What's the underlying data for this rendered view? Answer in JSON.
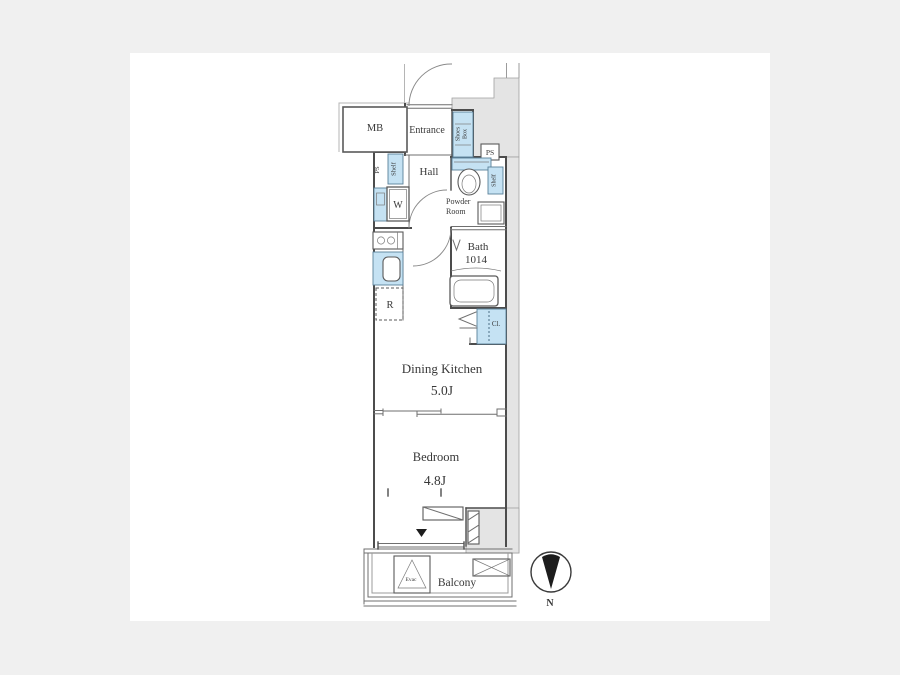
{
  "title": "apartment-floor-plan",
  "colors": {
    "bg": "#f0f0f0",
    "panel": "#ffffff",
    "line": "#4c4c4c",
    "wallGray": "#e4e4e4",
    "fixtureBlue": "#c5e2f3",
    "text": "#383838"
  },
  "labels": {
    "mb": "MB",
    "entrance": "Entrance",
    "shoes_box_line1": "Shoes",
    "shoes_box_line2": "Box",
    "ps_top_right": "PS",
    "ps_hall": "PS",
    "shelf_hall": "Shelf",
    "washing_machine": "W",
    "hall": "Hall",
    "powder_room_line1": "Powder",
    "powder_room_line2": "Room",
    "shelf_powder_room": "Shelf",
    "bath_line1": "Bath",
    "bath_line2": "1014",
    "refrigerator": "R",
    "closet": "Cl.",
    "dining_kitchen": "Dining Kitchen",
    "dining_kitchen_size": "5.0J",
    "bedroom": "Bedroom",
    "bedroom_size": "4.8J",
    "balcony": "Balcony",
    "evac_hatch": "Evac",
    "compass_north": "N"
  }
}
